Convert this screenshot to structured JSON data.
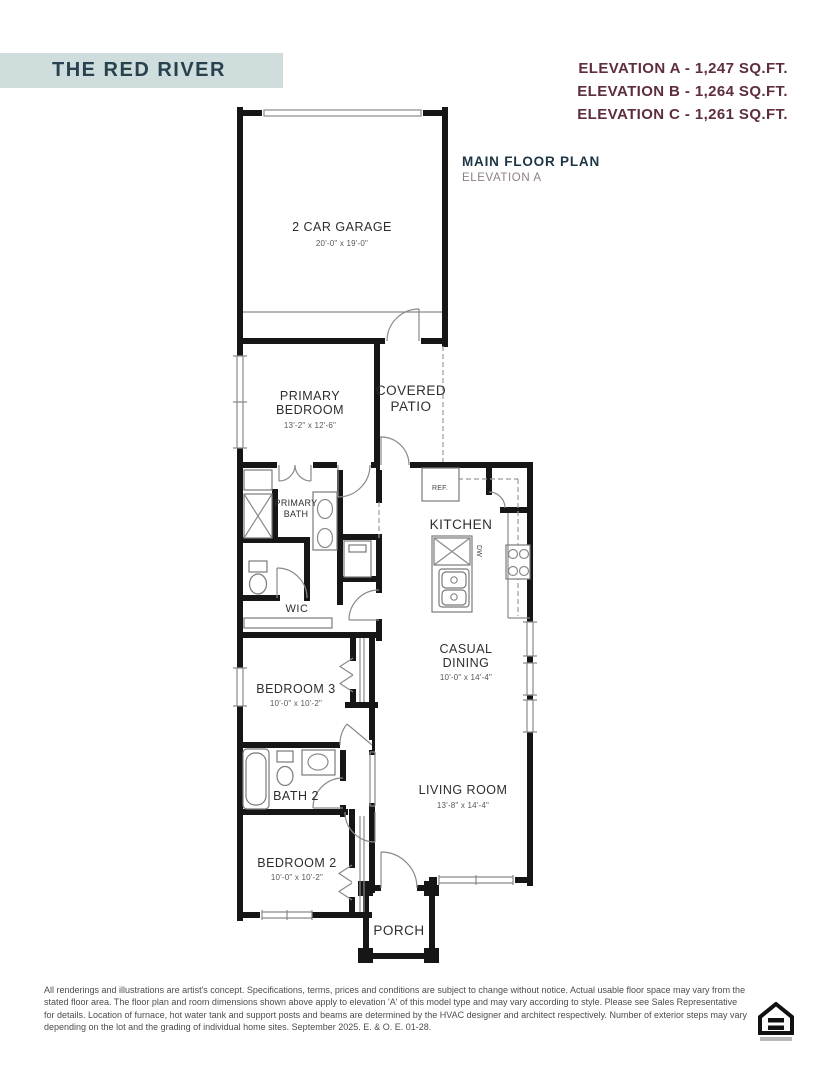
{
  "colors": {
    "banner_bg": "#cfdedd",
    "banner_text": "#27414f",
    "elevation_text": "#5e2d40",
    "floor_title_text": "#1d3646",
    "floor_subtitle_text": "#8d8089",
    "wall": "#161616",
    "disclaimer_text": "#4c4c4c"
  },
  "header": {
    "plan_name": "THE RED RIVER",
    "elevations": [
      {
        "label": "ELEVATION A - 1,247 SQ.FT."
      },
      {
        "label": "ELEVATION B - 1,264 SQ.FT."
      },
      {
        "label": "ELEVATION C - 1,261 SQ.FT."
      }
    ],
    "floor_title": "MAIN FLOOR PLAN",
    "floor_subtitle": "ELEVATION A"
  },
  "rooms": {
    "garage": {
      "name": "2 CAR GARAGE",
      "dims": "20'-0\" x 19'-0\""
    },
    "primary_bedroom": {
      "line1": "PRIMARY",
      "line2": "BEDROOM",
      "dims": "13'-2\" x 12'-6\""
    },
    "covered_patio": {
      "line1": "COVERED",
      "line2": "PATIO"
    },
    "primary_bath": {
      "line1": "PRIMARY",
      "line2": "BATH"
    },
    "wic": {
      "name": "WIC"
    },
    "kitchen": {
      "name": "KITCHEN"
    },
    "casual_dining": {
      "line1": "CASUAL",
      "line2": "DINING",
      "dims": "10'-0\" x 14'-4\""
    },
    "bedroom3": {
      "name": "BEDROOM 3",
      "dims": "10'-0\" x 10'-2\""
    },
    "bath2": {
      "name": "BATH 2"
    },
    "living_room": {
      "name": "LIVING ROOM",
      "dims": "13'-8\" x 14'-4\""
    },
    "bedroom2": {
      "name": "BEDROOM 2",
      "dims": "10'-0\" x 10'-2\""
    },
    "porch": {
      "name": "PORCH"
    }
  },
  "fixtures": {
    "ref": "REF.",
    "dw": "DW"
  },
  "footer": {
    "disclaimer": "All renderings and illustrations are artist's concept. Specifications, terms, prices and conditions are subject to change without notice. Actual usable floor space may vary from the stated floor area. The floor plan and room dimensions shown above apply to elevation 'A' of this model type and may vary according to style. Please see Sales Representative for details. Location of furnace, hot water tank and support posts and beams are determined by the HVAC designer and architect respectively. Number of exterior steps may vary depending on the lot and the grading of individual home sites. September 2025. E. & O. E. 01-28."
  }
}
